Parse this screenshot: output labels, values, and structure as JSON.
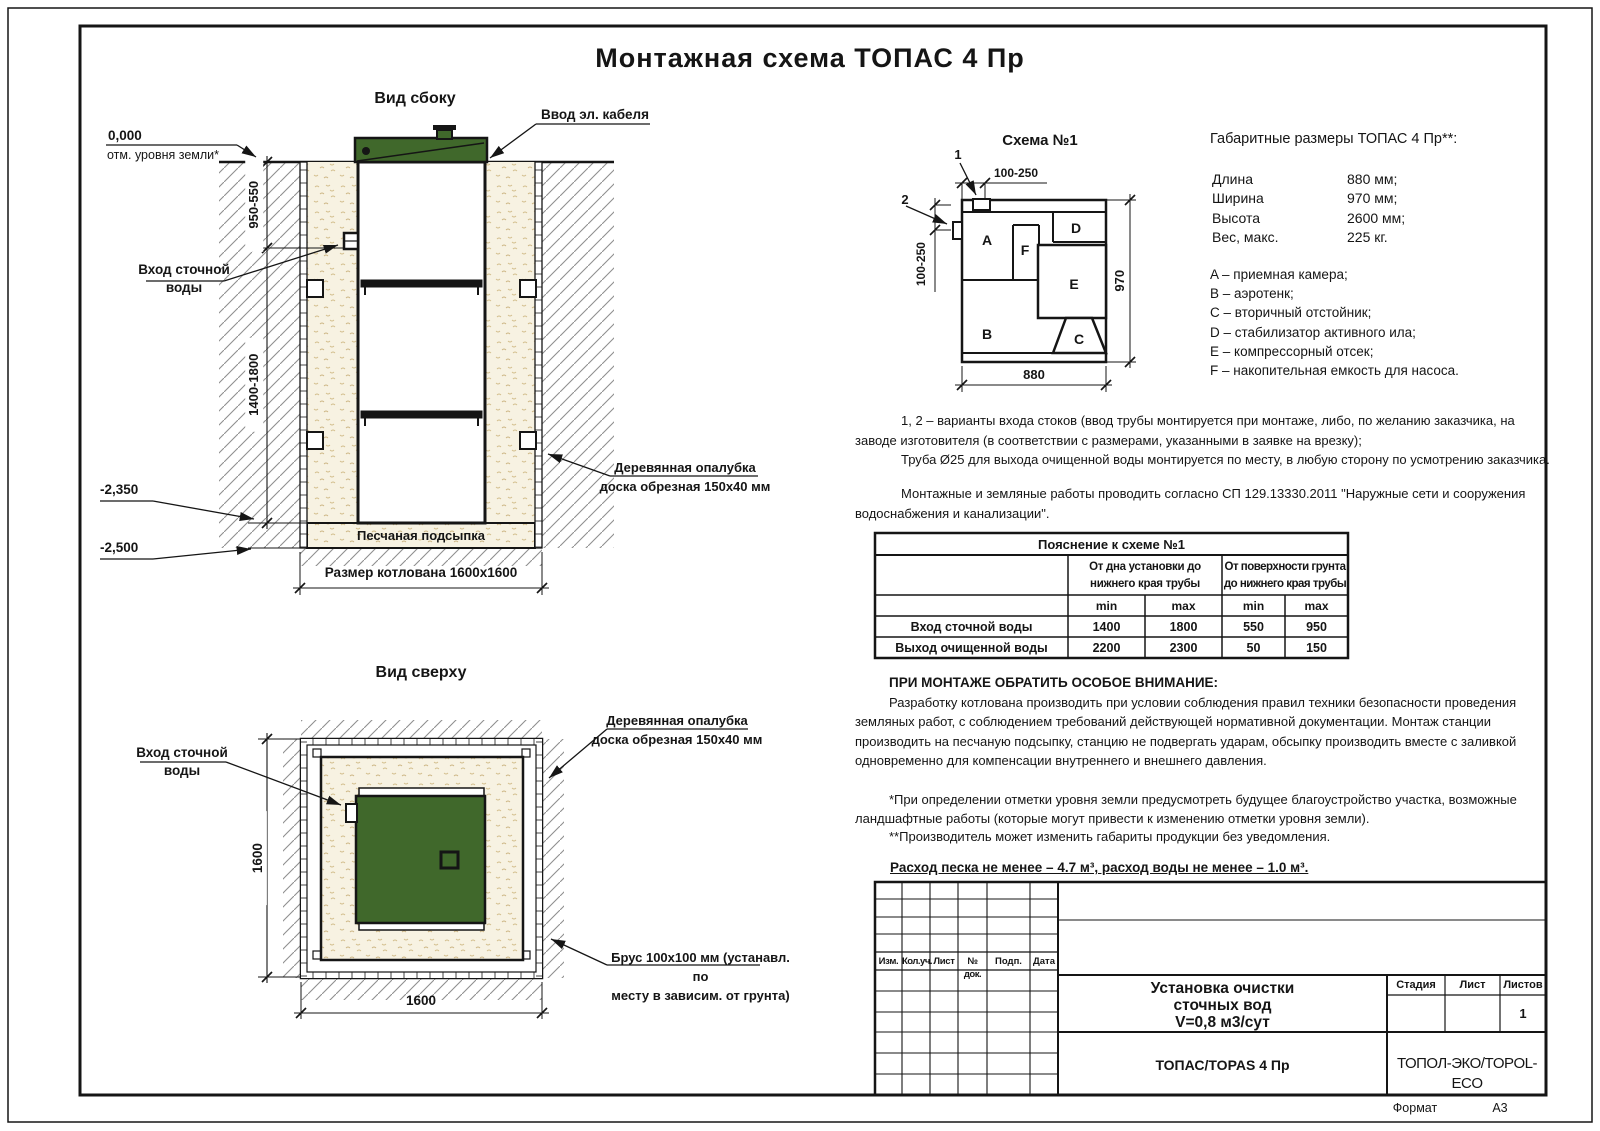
{
  "sheet": {
    "title": "Монтажная схема ТОПАС 4 Пр",
    "format_label": "Формат",
    "format_value": "А3"
  },
  "colors": {
    "unit_green": "#40682b",
    "sand": "#f7f2e2"
  },
  "side_view": {
    "title": "Вид сбоку",
    "cable_label": "Ввод эл. кабеля",
    "zero_mark": "0,000",
    "ground_note": "отм. уровня земли*",
    "dim_upper": "950-550",
    "dim_lower": "1400-1800",
    "inlet_label": "Вход сточной\nводы",
    "level_1": "-2,350",
    "level_2": "-2,500",
    "sand_label": "Песчаная подсыпка",
    "pit_label": "Размер котлована 1600x1600",
    "formwork_label": "Деревянная опалубка\nдоска обрезная 150x40 мм"
  },
  "top_view": {
    "title": "Вид сверху",
    "inlet_label": "Вход сточной\nводы",
    "formwork_label": "Деревянная опалубка\nдоска обрезная 150x40 мм",
    "beam_label": "Брус 100x100 мм (устанавл. по\nместу в зависим. от грунта)",
    "dim_vertical": "1600",
    "dim_horizontal": "1600"
  },
  "schema": {
    "title": "Схема №1",
    "marker_1": "1",
    "marker_2": "2",
    "dim_top": "100-250",
    "dim_left": "100-250",
    "dim_width": "880",
    "dim_height": "970",
    "compartments": [
      "A",
      "B",
      "C",
      "D",
      "E",
      "F"
    ]
  },
  "specs": {
    "heading": "Габаритные размеры ТОПАС 4 Пр**:",
    "rows": [
      {
        "label": "Длина",
        "value": "880 мм;"
      },
      {
        "label": "Ширина",
        "value": "970 мм;"
      },
      {
        "label": "Высота",
        "value": "2600 мм;"
      },
      {
        "label": "Вес, макс.",
        "value": "225 кг."
      }
    ],
    "legend": [
      "A – приемная камера;",
      "B – аэротенк;",
      "C – вторичный отстойник;",
      "D – стабилизатор активного ила;",
      "E – компрессорный отсек;",
      "F – накопительная емкость для насоса."
    ]
  },
  "notes": {
    "variants_a": "1, 2 – варианты входа  стоков (ввод трубы монтируется при монтаже, либо, по желанию заказчика, на\nзаводе изготовителя (в соответствии с размерами, указанными в заявке на врезку);",
    "variants_b": "Труба Ø25 для выхода очищенной воды монтируется по месту, в любую сторону по усмотрению заказчика.",
    "works": "Монтажные и земляные работы проводить согласно СП 129.13330.2011 \"Наружные сети и сооружения\nводоснабжения и канализации\".",
    "attention_heading": "ПРИ МОНТАЖЕ ОБРАТИТЬ ОСОБОЕ ВНИМАНИЕ:",
    "attention_body": "Разработку котлована производить при условии соблюдения правил техники безопасности проведения\nземляных работ, с соблюдением требований действующей нормативной документации. Монтаж станции\nпроизводить на песчаную подсыпку, станцию не подвергать ударам, обсыпку производить вместе с заливкой\nодновременно для компенсации внутреннего и внешнего давления.",
    "footnote_1": "*При определении отметки уровня земли предусмотреть будущее благоустройство участка, возможные\nландшафтные работы (которые могут привести к изменению отметки уровня земли).",
    "footnote_2": "**Производитель может изменить габариты продукции без уведомления.",
    "consumption": "Расход песка не менее – 4.7 м³, расход воды не менее – 1.0 м³."
  },
  "table": {
    "title": "Пояснение к схеме №1",
    "group_1": "От дна установки до\nнижнего края трубы",
    "group_2": "От поверхности грунта\nдо нижнего края трубы",
    "min_1": "min",
    "max_1": "max",
    "min_2": "min",
    "max_2": "max",
    "rows": [
      {
        "label": "Вход сточной воды",
        "v1": "1400",
        "v2": "1800",
        "v3": "550",
        "v4": "950"
      },
      {
        "label": "Выход очищенной воды",
        "v1": "2200",
        "v2": "2300",
        "v3": "50",
        "v4": "150"
      }
    ]
  },
  "stamp": {
    "rev_headers": [
      "Изм.",
      "Кол.уч.",
      "Лист",
      "№ док.",
      "Подп.",
      "Дата"
    ],
    "doc_title": "Установка очистки\nсточных вод\nV=0,8 м3/сут",
    "stage_label": "Стадия",
    "sheet_label": "Лист",
    "sheets_label": "Листов",
    "sheets_value": "1",
    "model": "ТОПАС/TOPAS 4 Пр",
    "company": "ТОПОЛ-ЭКО/TOPOL-ECO"
  }
}
